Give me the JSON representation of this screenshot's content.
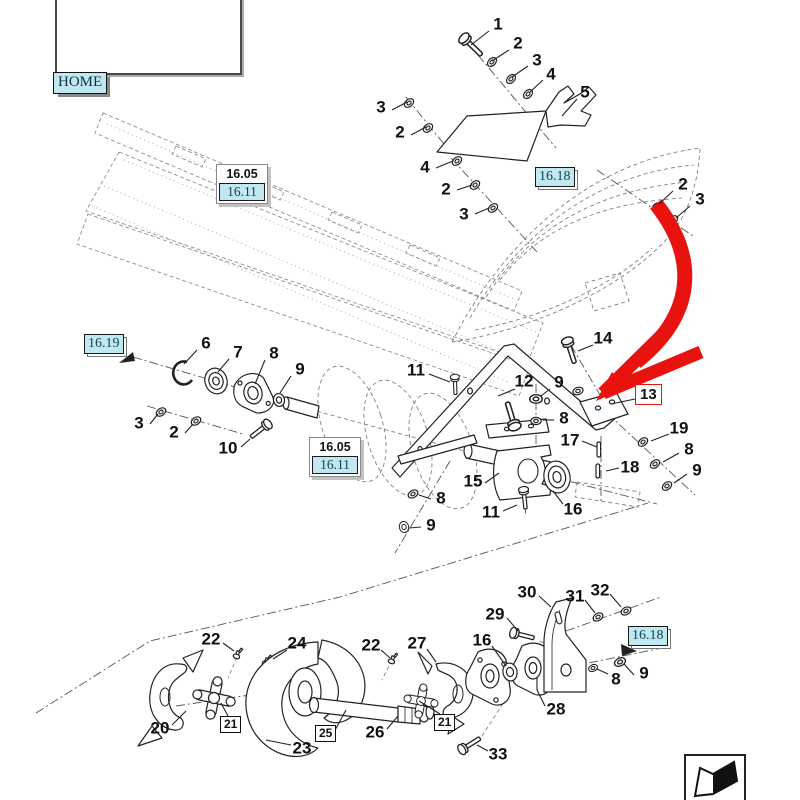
{
  "nav": {
    "home_label": "HOME"
  },
  "colors": {
    "highlight_fill": "#bfe8f0",
    "link_text": "#123f52",
    "red_accent": "#e8120f",
    "line": "#222222"
  },
  "stacked_ref_boxes": [
    {
      "x": 216,
      "y": 164,
      "top": "16.05",
      "bottom": "16.11"
    },
    {
      "x": 309,
      "y": 437,
      "top": "16.05",
      "bottom": "16.11"
    }
  ],
  "link_ref_boxes": [
    {
      "x": 535,
      "y": 167,
      "label": "16.18"
    },
    {
      "x": 84,
      "y": 334,
      "label": "16.19"
    },
    {
      "x": 628,
      "y": 626,
      "label": "16.18"
    }
  ],
  "boxed_callouts": [
    {
      "x": 220,
      "y": 716,
      "label": "21",
      "leader": [
        [
          228,
          716
        ],
        [
          221,
          703
        ]
      ]
    },
    {
      "x": 434,
      "y": 714,
      "label": "21",
      "leader": [
        [
          440,
          714
        ],
        [
          419,
          701
        ]
      ]
    },
    {
      "x": 315,
      "y": 725,
      "label": "25",
      "leader": [
        [
          334,
          732
        ],
        [
          346,
          710
        ]
      ]
    }
  ],
  "highlighted_callout": {
    "x": 635,
    "y": 384,
    "label": "13",
    "leader": [
      [
        635,
        399
      ],
      [
        611,
        404
      ]
    ]
  },
  "callouts": [
    {
      "label": "1",
      "x": 498,
      "y": 24,
      "leader": [
        [
          489,
          31
        ],
        [
          471,
          45
        ]
      ]
    },
    {
      "label": "2",
      "x": 518,
      "y": 43,
      "leader": [
        [
          509,
          50
        ],
        [
          492,
          61
        ]
      ]
    },
    {
      "label": "3",
      "x": 537,
      "y": 60,
      "leader": [
        [
          528,
          66
        ],
        [
          512,
          77
        ]
      ]
    },
    {
      "label": "4",
      "x": 551,
      "y": 74,
      "leader": [
        [
          543,
          80
        ],
        [
          530,
          92
        ]
      ]
    },
    {
      "label": "5",
      "x": 585,
      "y": 92,
      "leader": [
        [
          577,
          99
        ],
        [
          562,
          116
        ]
      ]
    },
    {
      "label": "3",
      "x": 381,
      "y": 107,
      "leader": [
        [
          392,
          110
        ],
        [
          407,
          102
        ]
      ]
    },
    {
      "label": "2",
      "x": 400,
      "y": 132,
      "leader": [
        [
          411,
          135
        ],
        [
          426,
          127
        ]
      ]
    },
    {
      "label": "4",
      "x": 425,
      "y": 167,
      "leader": [
        [
          436,
          168
        ],
        [
          453,
          161
        ]
      ]
    },
    {
      "label": "2",
      "x": 446,
      "y": 189,
      "leader": [
        [
          457,
          190
        ],
        [
          472,
          185
        ]
      ]
    },
    {
      "label": "3",
      "x": 464,
      "y": 214,
      "leader": [
        [
          475,
          214
        ],
        [
          489,
          208
        ]
      ]
    },
    {
      "label": "2",
      "x": 683,
      "y": 184,
      "leader": [
        [
          673,
          191
        ],
        [
          659,
          204
        ]
      ]
    },
    {
      "label": "3",
      "x": 700,
      "y": 199,
      "leader": [
        [
          690,
          206
        ],
        [
          676,
          218
        ]
      ]
    },
    {
      "label": "14",
      "x": 603,
      "y": 338,
      "leader": [
        [
          593,
          345
        ],
        [
          578,
          351
        ]
      ]
    },
    {
      "label": "6",
      "x": 206,
      "y": 343,
      "leader": [
        [
          197,
          350
        ],
        [
          184,
          364
        ]
      ]
    },
    {
      "label": "7",
      "x": 238,
      "y": 352,
      "leader": [
        [
          229,
          359
        ],
        [
          218,
          372
        ]
      ]
    },
    {
      "label": "8",
      "x": 274,
      "y": 353,
      "leader": [
        [
          265,
          360
        ],
        [
          255,
          384
        ]
      ]
    },
    {
      "label": "9",
      "x": 300,
      "y": 369,
      "leader": [
        [
          291,
          376
        ],
        [
          280,
          393
        ]
      ]
    },
    {
      "label": "11",
      "x": 416,
      "y": 370,
      "leader": [
        [
          429,
          374
        ],
        [
          450,
          382
        ]
      ]
    },
    {
      "label": "12",
      "x": 524,
      "y": 381,
      "leader": [
        [
          515,
          389
        ],
        [
          498,
          396
        ]
      ]
    },
    {
      "label": "9",
      "x": 559,
      "y": 382,
      "leader": [
        [
          550,
          389
        ],
        [
          541,
          396
        ]
      ]
    },
    {
      "label": "8",
      "x": 564,
      "y": 418,
      "leader": [
        [
          554,
          420
        ],
        [
          543,
          420
        ]
      ]
    },
    {
      "label": "3",
      "x": 139,
      "y": 423,
      "leader": [
        [
          150,
          424
        ],
        [
          158,
          414
        ]
      ]
    },
    {
      "label": "2",
      "x": 174,
      "y": 432,
      "leader": [
        [
          185,
          433
        ],
        [
          193,
          424
        ]
      ]
    },
    {
      "label": "19",
      "x": 679,
      "y": 428,
      "leader": [
        [
          669,
          434
        ],
        [
          651,
          441
        ]
      ]
    },
    {
      "label": "10",
      "x": 228,
      "y": 448,
      "leader": [
        [
          241,
          447
        ],
        [
          250,
          439
        ]
      ]
    },
    {
      "label": "17",
      "x": 570,
      "y": 440,
      "leader": [
        [
          582,
          441
        ],
        [
          597,
          447
        ]
      ]
    },
    {
      "label": "8",
      "x": 689,
      "y": 449,
      "leader": [
        [
          679,
          453
        ],
        [
          663,
          462
        ]
      ]
    },
    {
      "label": "18",
      "x": 630,
      "y": 467,
      "leader": [
        [
          619,
          468
        ],
        [
          606,
          471
        ]
      ]
    },
    {
      "label": "9",
      "x": 697,
      "y": 470,
      "leader": [
        [
          687,
          474
        ],
        [
          674,
          483
        ]
      ]
    },
    {
      "label": "15",
      "x": 473,
      "y": 481,
      "leader": [
        [
          485,
          483
        ],
        [
          499,
          473
        ]
      ]
    },
    {
      "label": "8",
      "x": 441,
      "y": 498,
      "leader": [
        [
          431,
          499
        ],
        [
          419,
          495
        ]
      ]
    },
    {
      "label": "16",
      "x": 573,
      "y": 509,
      "leader": [
        [
          563,
          504
        ],
        [
          553,
          491
        ]
      ]
    },
    {
      "label": "11",
      "x": 491,
      "y": 512,
      "leader": [
        [
          503,
          511
        ],
        [
          517,
          505
        ]
      ]
    },
    {
      "label": "9",
      "x": 431,
      "y": 525,
      "leader": [
        [
          421,
          527
        ],
        [
          409,
          528
        ]
      ]
    },
    {
      "label": "30",
      "x": 527,
      "y": 592,
      "leader": [
        [
          539,
          596
        ],
        [
          551,
          607
        ]
      ]
    },
    {
      "label": "31",
      "x": 575,
      "y": 596,
      "leader": [
        [
          585,
          600
        ],
        [
          595,
          613
        ]
      ]
    },
    {
      "label": "32",
      "x": 600,
      "y": 590,
      "leader": [
        [
          610,
          594
        ],
        [
          621,
          607
        ]
      ]
    },
    {
      "label": "29",
      "x": 495,
      "y": 614,
      "leader": [
        [
          507,
          618
        ],
        [
          518,
          631
        ]
      ]
    },
    {
      "label": "22",
      "x": 211,
      "y": 639,
      "leader": [
        [
          223,
          643
        ],
        [
          234,
          651
        ]
      ]
    },
    {
      "label": "24",
      "x": 297,
      "y": 643,
      "leader": [
        [
          287,
          650
        ],
        [
          273,
          659
        ]
      ]
    },
    {
      "label": "27",
      "x": 417,
      "y": 643,
      "leader": [
        [
          427,
          649
        ],
        [
          436,
          662
        ]
      ]
    },
    {
      "label": "16",
      "x": 482,
      "y": 640,
      "leader": [
        [
          492,
          646
        ],
        [
          506,
          666
        ]
      ]
    },
    {
      "label": "22",
      "x": 371,
      "y": 645,
      "leader": [
        [
          381,
          650
        ],
        [
          390,
          658
        ]
      ]
    },
    {
      "label": "8",
      "x": 616,
      "y": 679,
      "leader": [
        [
          608,
          674
        ],
        [
          597,
          669
        ]
      ]
    },
    {
      "label": "9",
      "x": 644,
      "y": 673,
      "leader": [
        [
          634,
          675
        ],
        [
          624,
          664
        ]
      ]
    },
    {
      "label": "28",
      "x": 556,
      "y": 709,
      "leader": [
        [
          545,
          706
        ],
        [
          537,
          690
        ],
        [
          537,
          678
        ]
      ]
    },
    {
      "label": "20",
      "x": 160,
      "y": 728,
      "leader": [
        [
          172,
          725
        ],
        [
          186,
          711
        ]
      ]
    },
    {
      "label": "26",
      "x": 375,
      "y": 732,
      "leader": [
        [
          387,
          729
        ],
        [
          398,
          716
        ]
      ]
    },
    {
      "label": "23",
      "x": 302,
      "y": 748,
      "leader": [
        [
          291,
          745
        ],
        [
          266,
          740
        ]
      ]
    },
    {
      "label": "33",
      "x": 498,
      "y": 754,
      "leader": [
        [
          488,
          751
        ],
        [
          477,
          745
        ]
      ]
    }
  ],
  "corner_icon": {
    "name": "page-flip-icon"
  }
}
